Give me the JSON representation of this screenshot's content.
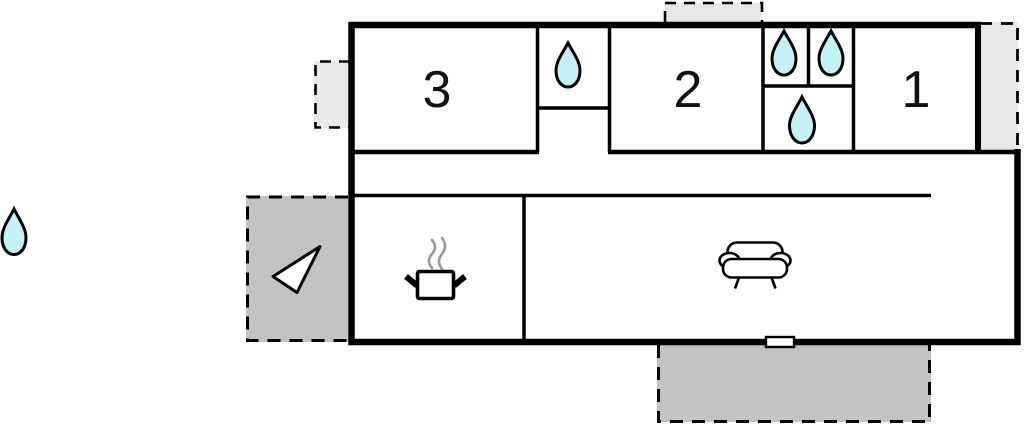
{
  "plan": {
    "type": "floor-plan",
    "rooms": [
      {
        "label": "3"
      },
      {
        "label": "2"
      },
      {
        "label": "1"
      }
    ],
    "colors": {
      "water_drop": "#c6f1f6",
      "patio_dark": "#c3c3c3",
      "patio_light": "#e8e8e8",
      "wall": "#000000",
      "steam": "#9a9a9a",
      "icon_fill": "#ffffff"
    },
    "icons": [
      {
        "name": "water-drop-icon"
      },
      {
        "name": "entrance-arrow-icon"
      },
      {
        "name": "cooking-pot-icon"
      },
      {
        "name": "steam-icon"
      },
      {
        "name": "sofa-icon"
      },
      {
        "name": "window-marker"
      }
    ]
  }
}
